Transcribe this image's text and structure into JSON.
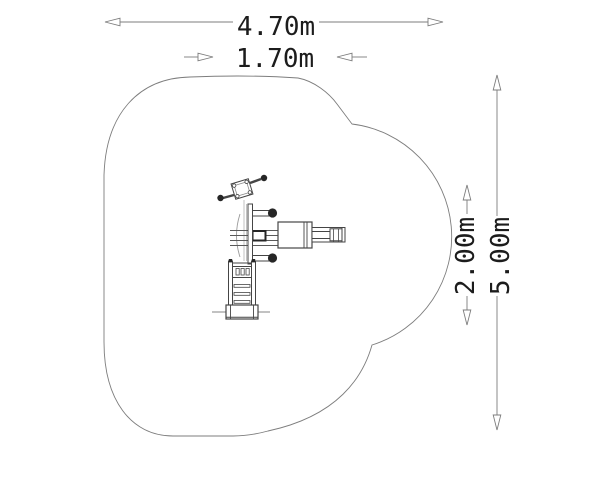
{
  "dimensions": {
    "total_width": {
      "label": "4.70m",
      "orientation": "horizontal"
    },
    "equipment_width": {
      "label": "1.70m",
      "orientation": "horizontal"
    },
    "equipment_depth": {
      "label": "2.00m",
      "orientation": "vertical"
    },
    "total_depth": {
      "label": "5.00m",
      "orientation": "vertical"
    }
  },
  "colors": {
    "background": "#ffffff",
    "outline": "#7d7d7d",
    "dimension_line": "#7d7d7d",
    "dimension_text": "#1c1c1c",
    "equipment_dark": "#454545",
    "equipment_light": "#c2c2c2",
    "knob_fill": "#262626"
  }
}
